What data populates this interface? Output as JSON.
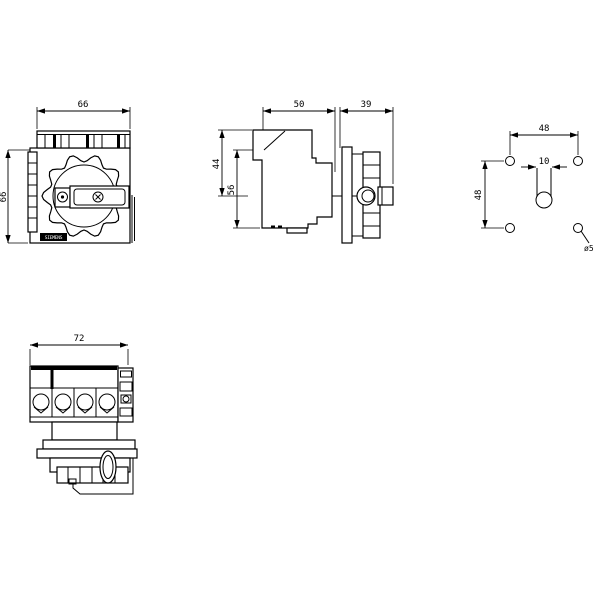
{
  "page": {
    "background": "#ffffff",
    "line_color": "#000000",
    "description": "switch-disconnector dimension drawing with four views"
  },
  "brand_label": "SIEMENS",
  "views": {
    "front": {
      "name": "front view",
      "dim_width": "66",
      "dim_height": "66"
    },
    "side": {
      "name": "side view",
      "dim_depth_body": "50",
      "dim_depth_handle": "39",
      "dim_top_to_handle_axis": "44",
      "dim_mounting_height": "56"
    },
    "drilling": {
      "name": "drilling pattern",
      "dim_hole_pitch_horizontal": "48",
      "dim_hole_pitch_vertical": "48",
      "dim_shaft_slot_width": "10",
      "dim_hole_diameter": "ø5"
    },
    "top": {
      "name": "top view",
      "dim_width": "72"
    }
  }
}
